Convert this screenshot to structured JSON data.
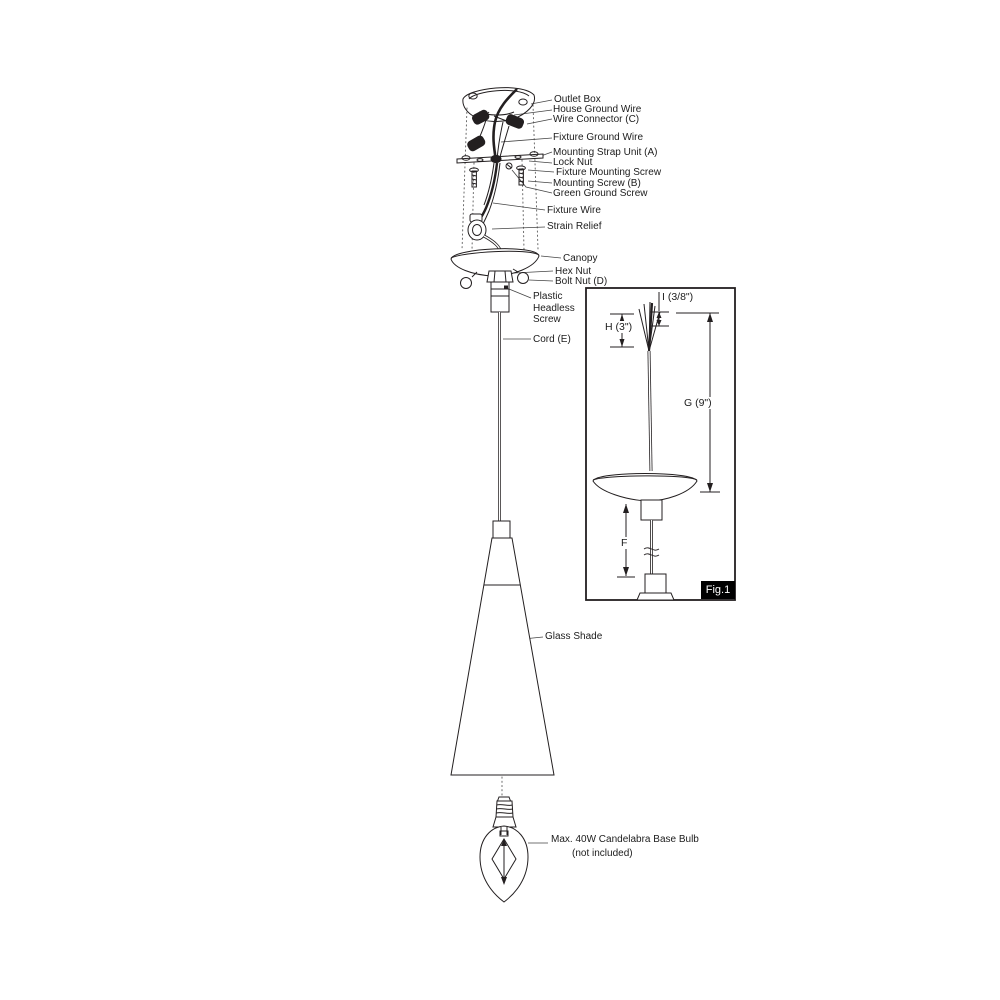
{
  "callouts": {
    "outlet_box": "Outlet Box",
    "house_ground_wire": "House Ground Wire",
    "wire_connector": "Wire Connector (C)",
    "fixture_ground_wire": "Fixture Ground Wire",
    "mounting_strap": "Mounting Strap Unit (A)",
    "lock_nut": "Lock Nut",
    "fixture_mounting_screw": "Fixture Mounting Screw",
    "mounting_screw": "Mounting Screw (B)",
    "green_ground_screw": "Green Ground Screw",
    "fixture_wire": "Fixture Wire",
    "strain_relief": "Strain Relief",
    "canopy": "Canopy",
    "hex_nut": "Hex Nut",
    "bolt_nut": "Bolt Nut (D)",
    "plastic_headless_screw": "Plastic Headless Screw",
    "cord": "Cord (E)",
    "glass_shade": "Glass Shade"
  },
  "bulb_note": {
    "line1": "Max. 40W Candelabra Base Bulb",
    "line2": "(not included)"
  },
  "fig1": {
    "caption": "Fig.1",
    "dims": {
      "i": "I (3/8\")",
      "h": "H (3\")",
      "g": "G (9\")",
      "f": "F"
    }
  },
  "colors": {
    "line": "#231f20",
    "leader": "#454545",
    "caption_bg": "#000000",
    "caption_text": "#ffffff"
  }
}
